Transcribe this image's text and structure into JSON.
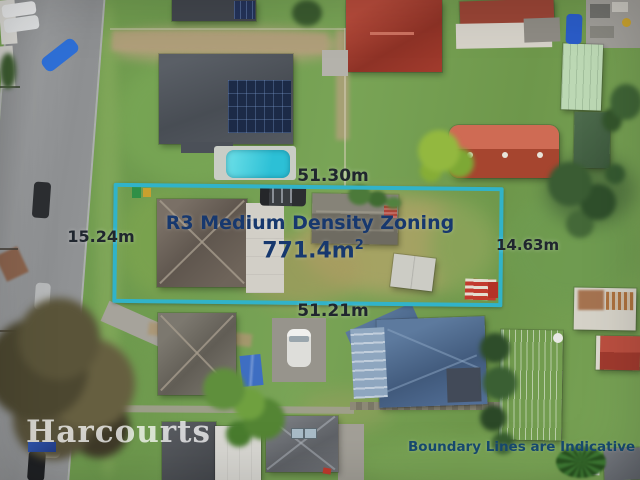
{
  "annotations": {
    "top_length": "51.30m",
    "left_length": "15.24m",
    "right_length": "14.63m",
    "bottom_length": "51.21m",
    "zoning": "R3 Medium Density Zoning",
    "area": "771.4m",
    "area_exponent": "2",
    "disclaimer": "Boundary Lines are Indicative Only"
  },
  "branding": {
    "watermark": "Harcourts"
  },
  "colors": {
    "boundary": "#31b3c9",
    "measure": "#20262e",
    "zoning": "#17386e",
    "disclaimer": "#174a70",
    "pool": "#2cc0d6",
    "watermark": "rgba(255,255,255,0.75)"
  }
}
